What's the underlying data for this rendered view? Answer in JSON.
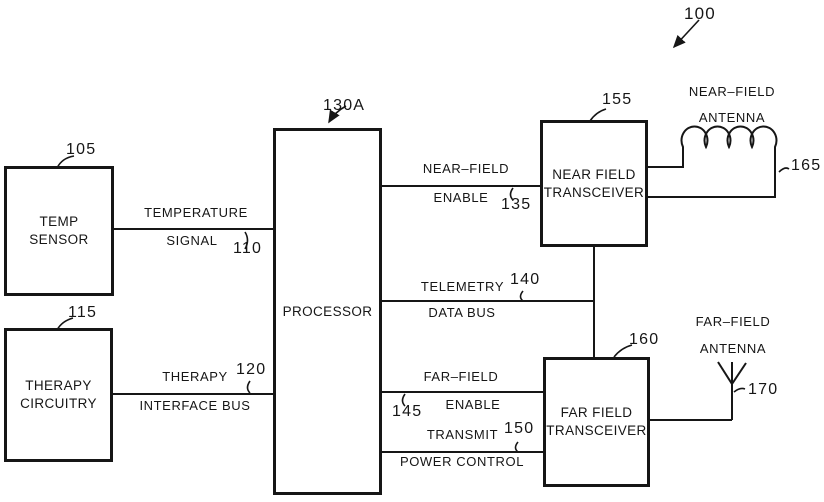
{
  "figure": {
    "ref": "100"
  },
  "boxes": {
    "temp_sensor": {
      "line1": "TEMP",
      "line2": "SENSOR",
      "ref": "105"
    },
    "therapy": {
      "line1": "THERAPY",
      "line2": "CIRCUITRY",
      "ref": "115"
    },
    "processor": {
      "label": "PROCESSOR",
      "ref": "130A"
    },
    "nf_transceiver": {
      "line1": "NEAR FIELD",
      "line2": "TRANSCEIVER",
      "ref": "155"
    },
    "ff_transceiver": {
      "line1": "FAR FIELD",
      "line2": "TRANSCEIVER",
      "ref": "160"
    }
  },
  "signals": {
    "temperature": {
      "line1": "TEMPERATURE",
      "line2": "SIGNAL",
      "ref": "110"
    },
    "therapy_bus": {
      "line1": "THERAPY",
      "line2": "INTERFACE BUS",
      "ref": "120"
    },
    "nf_enable": {
      "line1": "NEAR–FIELD",
      "line2": "ENABLE",
      "ref": "135"
    },
    "telemetry": {
      "line1": "TELEMETRY",
      "line2": "DATA BUS",
      "ref": "140"
    },
    "ff_enable": {
      "line1": "FAR–FIELD",
      "line2": "ENABLE",
      "ref": "145"
    },
    "tx_power": {
      "line1": "TRANSMIT",
      "line2": "POWER CONTROL",
      "ref": "150"
    }
  },
  "antennas": {
    "near_field": {
      "line1": "NEAR–FIELD",
      "line2": "ANTENNA",
      "ref": "165"
    },
    "far_field": {
      "line1": "FAR–FIELD",
      "line2": "ANTENNA",
      "ref": "170"
    }
  },
  "colors": {
    "ink": "#161616",
    "background": "#ffffff"
  }
}
